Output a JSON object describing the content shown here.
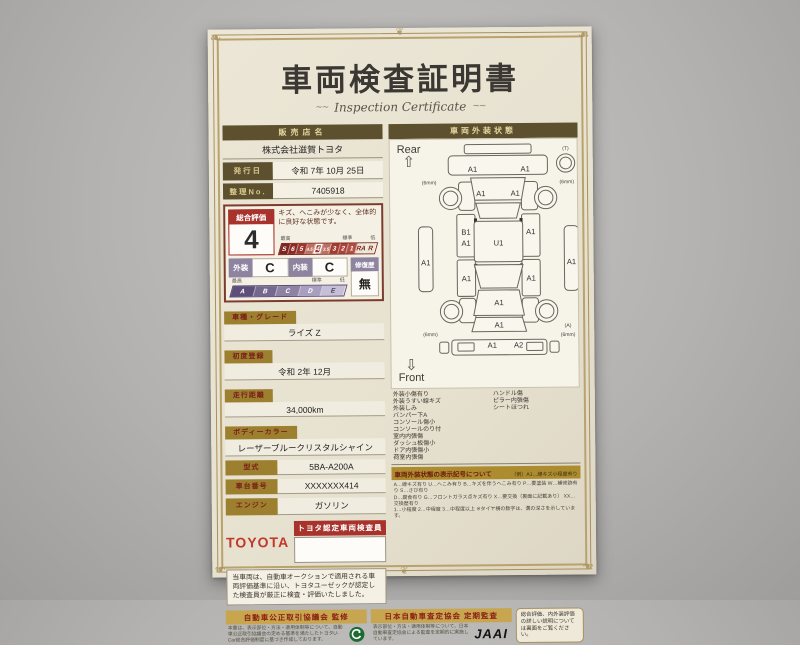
{
  "title": {
    "main": "車両検査証明書",
    "sub": "Inspection Certificate"
  },
  "header": {
    "dealer_label": "販売店名",
    "dealer_name": "株式会社滋賀トヨタ",
    "issue_date_label": "発行日",
    "issue_date": "令和 7年 10月 25日",
    "ref_no_label": "整理No.",
    "ref_no": "7405918"
  },
  "evaluation": {
    "overall_label": "総合評価",
    "overall_grade": "4",
    "overall_comment": "キズ、へこみが少なく、全体的に良好な状態です。",
    "scale_best": "最高",
    "scale_standard": "標準",
    "scale_low": "低",
    "overall_scale": [
      "S",
      "6",
      "5",
      "4.5",
      "4",
      "3.5",
      "3",
      "2",
      "1",
      "RA",
      "R"
    ],
    "exterior_label": "外装",
    "exterior_grade": "C",
    "interior_label": "内装",
    "interior_grade": "C",
    "interior_scale": [
      "A",
      "B",
      "C",
      "D",
      "E"
    ],
    "repair_label": "修復歴",
    "repair_value": "無"
  },
  "fields": [
    {
      "label": "車種・グレード",
      "value": "ライズ Z"
    },
    {
      "label": "初度登録",
      "value": "令和 2年 12月"
    },
    {
      "label": "走行距離",
      "value": "34,000km"
    },
    {
      "label": "ボディーカラー",
      "value": "レーザーブルークリスタルシャイン"
    }
  ],
  "fields_inline": [
    {
      "label": "型式",
      "value": "5BA-A200A"
    },
    {
      "label": "車台番号",
      "value": "XXXXXXX414"
    },
    {
      "label": "エンジン",
      "value": "ガソリン"
    }
  ],
  "inspector": {
    "brand": "TOYOTA",
    "badge": "トヨタ認定車両検査員"
  },
  "statement": "当車両は、自動車オークションで適用される車両評価基準に沿い、トヨタユーゼックが認定した検査員が厳正に検査・評価いたしました。",
  "exterior_panel": {
    "title": "車両外装状態",
    "rear_label": "Rear",
    "front_label": "Front"
  },
  "diagram": {
    "labels": [
      {
        "t": "(T)",
        "x": 152,
        "y": 9,
        "s": 1
      },
      {
        "t": "A1",
        "x": 60,
        "y": 30
      },
      {
        "t": "A1",
        "x": 112,
        "y": 30
      },
      {
        "t": "(6mm)",
        "x": 17,
        "y": 42,
        "s": 1
      },
      {
        "t": "(6mm)",
        "x": 153,
        "y": 42,
        "s": 1
      },
      {
        "t": "A1",
        "x": 68,
        "y": 54
      },
      {
        "t": "A1",
        "x": 102,
        "y": 54
      },
      {
        "t": "B1",
        "x": 53,
        "y": 92
      },
      {
        "t": "A1",
        "x": 53,
        "y": 103
      },
      {
        "t": "A1",
        "x": 117,
        "y": 92
      },
      {
        "t": "A1",
        "x": 13,
        "y": 122
      },
      {
        "t": "A1",
        "x": 53,
        "y": 138
      },
      {
        "t": "A1",
        "x": 117,
        "y": 138
      },
      {
        "t": "A1",
        "x": 157,
        "y": 122
      },
      {
        "t": "U1",
        "x": 85,
        "y": 103
      },
      {
        "t": "A1",
        "x": 85,
        "y": 162
      },
      {
        "t": "A1",
        "x": 85,
        "y": 184
      },
      {
        "t": "(6mm)",
        "x": 17,
        "y": 192,
        "s": 1
      },
      {
        "t": "(A)",
        "x": 153,
        "y": 184,
        "s": 1
      },
      {
        "t": "(6mm)",
        "x": 153,
        "y": 193,
        "s": 1
      },
      {
        "t": "A1",
        "x": 78,
        "y": 204
      },
      {
        "t": "A2",
        "x": 104,
        "y": 204
      }
    ]
  },
  "defects": {
    "left": [
      "外装小傷有り",
      "外装うすい線キズ",
      "外装しみ",
      "バンパー下A",
      "コンソール傷小",
      "コンソールのり付",
      "室内内張傷",
      "ダッシュ板傷小",
      "ドア内張傷小",
      "荷室内張傷"
    ],
    "right": [
      "ハンドル傷",
      "ピラー内張傷",
      "シートほつれ"
    ]
  },
  "legend": {
    "title": "車両外装状態の表示記号について",
    "example": "（例）A1…線キズ小程度有り",
    "lines": [
      "A…線キズ有り U…へこみ有り B…キズを伴うへこみ有り P…要塗装 W…補修跡有り S…さび有り",
      "D…腐食有り G…フロントガラス点キズ有り X…要交換（裏面に記載あり） XX…交換歴有り",
      "1…小程度 2…中程度 3…中程度以上 ※タイヤ横の数字は、溝の深さを示しています。"
    ]
  },
  "footer": {
    "fair_trade_title": "自動車公正取引協議会 監修",
    "fair_trade_text": "本書は、表示部位・方法・適用体制等について、自動車公正取引協議会の定める基準を満たしたトヨタU-Car総合評価制度に基づき作成しております。",
    "jaai_title": "日本自動車査定協会 定期監査",
    "jaai_text": "表示部位・方法・適用体制等について、日本自動車査定協会による監査を定期的に実施しています。",
    "jaai_logo": "JAAI",
    "back_note": "総合評価、内外装評価の詳しい説明については裏面をご覧ください。"
  },
  "colors": {
    "accent_red": "#a8332c",
    "label_gold": "#9c8030",
    "header_olive": "#5c502e",
    "scale_purple": "#8e84a0",
    "toyota_red": "#c0392b"
  }
}
